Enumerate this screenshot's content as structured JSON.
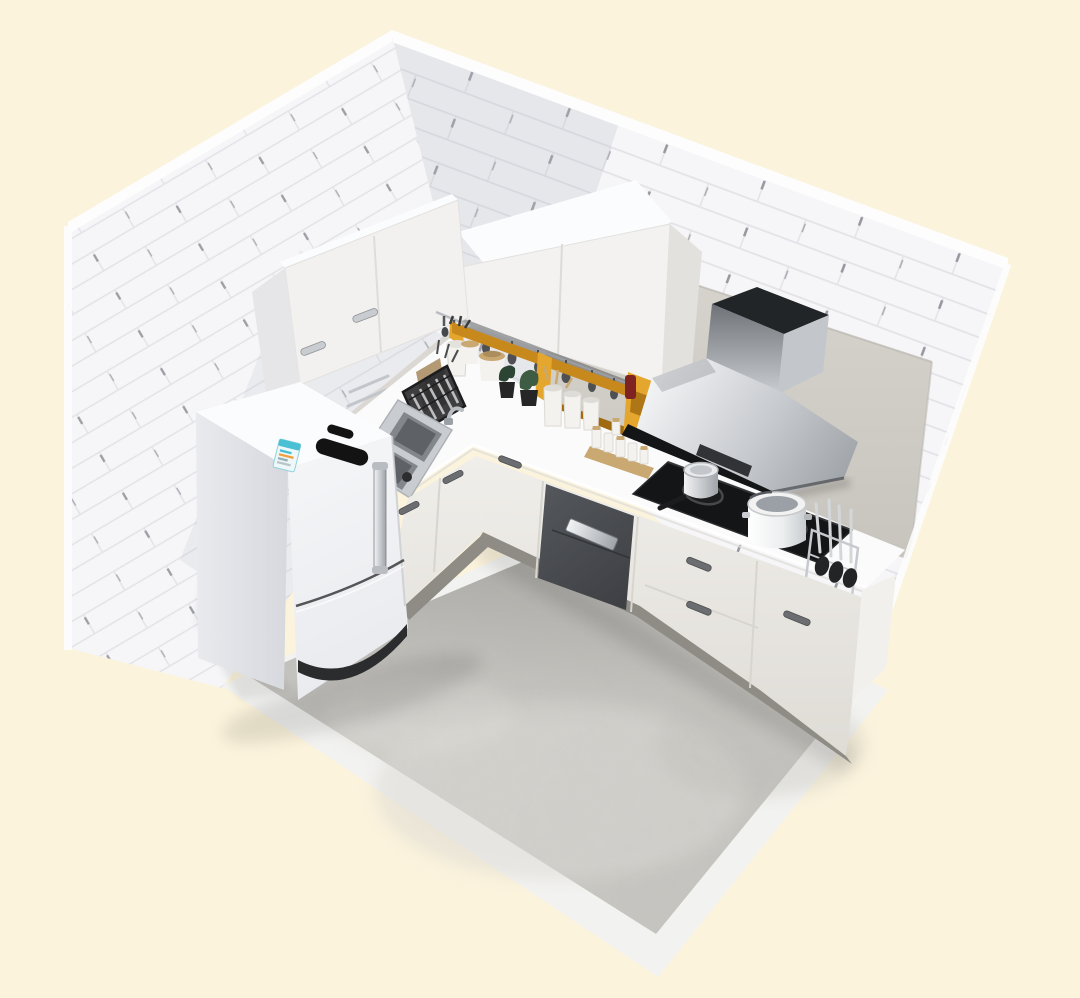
{
  "meta": {
    "kind": "3d-interior-render",
    "description": "Isometric cutaway render of a small white L-shaped kitchen with yellow open shelving",
    "canvas": {
      "width": 1080,
      "height": 998
    },
    "visible_text": []
  },
  "colors": {
    "background": "#FBF3DC",
    "brick": "#F6F6F8",
    "mortar": "#E2E2E8",
    "brickTick": "#85858D",
    "wallEdge": "#FDFDFE",
    "wallShade": "#B9BAC2",
    "panel": "#D8D5CF",
    "panelDark": "#C7C4BD",
    "floorA": "#D2D0CB",
    "floorB": "#C5C3BE",
    "floorBorder": "#F2F2F0",
    "counter": "#FBFBFC",
    "counterShade": "#E0DED9",
    "fasciaA": "#F1EFEB",
    "fasciaB": "#DEDBD5",
    "toe": "#8E8C85",
    "darkUnitA": "#55585C",
    "darkUnitB": "#3B3D41",
    "yellow": "#E4A62C",
    "yellowDark": "#C8891C",
    "yellowDeep": "#A06A10",
    "steelA": "#F2F3F5",
    "steelB": "#9FA4A9",
    "steelC": "#6E7177",
    "chrome": "#C9CCD0",
    "black": "#141517",
    "plinth": "#2B2C2E",
    "fridgeFront": "#F5F6F8",
    "fridgeFrontB": "#E8E9ED",
    "fridgeSideA": "#E9EAEE",
    "fridgeSideB": "#D4D6DB",
    "fridgeTop": "#FBFCFD",
    "wood": "#C9A872",
    "woodDark": "#9A7B4F",
    "boardTan": "#B49A74",
    "boardDark": "#6E6152",
    "plant": "#3E5C43",
    "plantDark": "#2C4433",
    "potBlack": "#262626",
    "jar": "#F3F2EF",
    "jarShade": "#DEDCD6",
    "labelTeal": "#49C0D4",
    "labelOrange": "#F0A03C",
    "redBottle": "#7E2222",
    "sinkRim": "#C9CDD1",
    "sinkBowl": "#83878C",
    "sinkDeep": "#5E6267",
    "handleDark": "#6B6D70"
  },
  "scene": {
    "room": {
      "left_wall": "white subway brick, cut away at top-left",
      "right_wall": "white subway brick with large grey backsplash panel",
      "floor": "grey concrete slab with white border strips on the two open edges"
    },
    "objects": [
      {
        "id": "refrigerator",
        "label": "white two-door bottom-freezer refrigerator with chrome handle, dark brand badge and teal energy-efficiency sticker"
      },
      {
        "id": "sink",
        "label": "stainless double-bowl sink with small chrome faucet and dark drain knob"
      },
      {
        "id": "dish-rack",
        "label": "black wire dish rack holding plates and cutlery"
      },
      {
        "id": "cutting-boards",
        "label": "wooden cutting boards leaning on backsplash"
      },
      {
        "id": "utensil-crock",
        "label": "white crock with cooking utensils"
      },
      {
        "id": "canisters",
        "label": "white storage canisters with wooden lids"
      },
      {
        "id": "plants",
        "label": "two small green plants in black pots"
      },
      {
        "id": "open-shelf",
        "label": "mustard-yellow open shelf unit along back wall"
      },
      {
        "id": "spice-jars",
        "label": "white jars and spice bottle set on wooden tray"
      },
      {
        "id": "red-bottle",
        "label": "dark red bottle beside wall cabinet"
      },
      {
        "id": "wall-cabinet-left",
        "label": "tall white wall cabinet on left wall with chrome handles"
      },
      {
        "id": "wall-cabinet-back",
        "label": "white double-door wall cabinet on back wall"
      },
      {
        "id": "range-hood",
        "label": "stainless chimney range hood with black front band"
      },
      {
        "id": "cooktop",
        "label": "black glass two-burner gas cooktop"
      },
      {
        "id": "saucepan",
        "label": "small stainless saucepan with black handle"
      },
      {
        "id": "stockpot",
        "label": "large white stockpot"
      },
      {
        "id": "utensil-stand",
        "label": "chrome utensil stand with spatulas and ladles"
      },
      {
        "id": "sterilizer-cabinet",
        "label": "dark built-in sterilizer / dishwasher unit with steel handle"
      },
      {
        "id": "base-cabinets",
        "label": "light base cabinets and drawers with metal handles"
      },
      {
        "id": "countertop",
        "label": "white L-shaped countertop"
      },
      {
        "id": "towel-bar",
        "label": "chrome towel bar on left backsplash"
      },
      {
        "id": "rail-hooks",
        "label": "wall rail with hanging utensils under back cabinet"
      }
    ]
  }
}
